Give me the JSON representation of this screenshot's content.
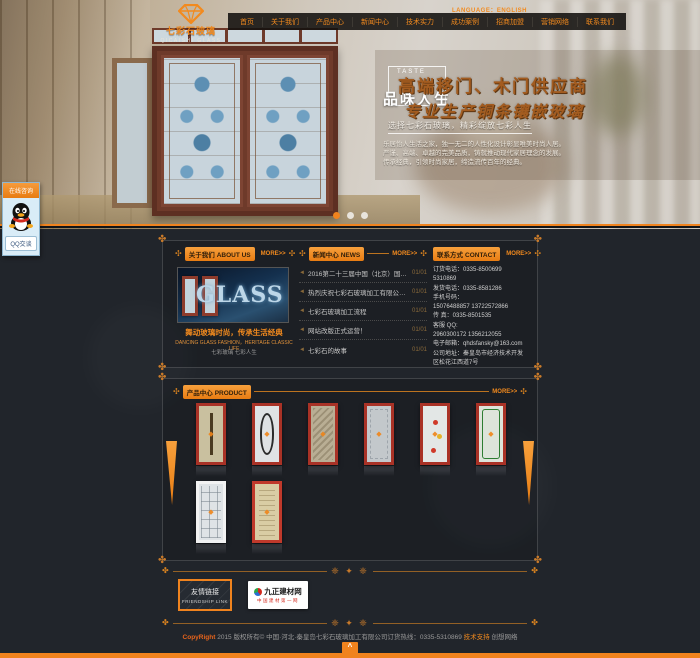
{
  "brand": {
    "logo_cn": "七彩石玻璃",
    "logo_en": "QICAISHI GLASS"
  },
  "topbar": {
    "language": "LANGUAGE：ENGLISH"
  },
  "nav": {
    "items": [
      "首页",
      "关于我们",
      "产品中心",
      "新闻中心",
      "技术实力",
      "成功案例",
      "招商加盟",
      "营销网络",
      "联系我们"
    ]
  },
  "banner": {
    "taste_en": "TASTE",
    "taste_cn": "品味人生",
    "headline1": "高端移门、木门供应商",
    "headline2": "专业生产铜条镶嵌玻璃",
    "subline": "选择七彩石玻璃，精彩绽放七彩人生",
    "desc1": "乐居怡人生活之家，独一无二的人性化设计彰显唯美时尚人居。",
    "desc2": "严谨、高端、卓越的完美品质，铸就推动现代家居理念的发展。",
    "desc3": "传承经典，引领时尚家居，缔造流传百年的经典。",
    "dot_count": 3,
    "active_dot": 0
  },
  "qq": {
    "title": "在线咨询",
    "button": "QQ交谈"
  },
  "sections": {
    "about": {
      "title_cn": "关于我们",
      "title_en": "ABOUT US",
      "more": "MORE>>",
      "image_text": "GLASS",
      "caption1": "舞动玻璃时尚，传承生活经典",
      "caption2": "DANCING GLASS FASHION，HERITAGE CLASSIC LIFE",
      "caption3": "七彩玻璃 七彩人生"
    },
    "news": {
      "title_cn": "新闻中心",
      "title_en": "NEWS",
      "more": "MORE>>",
      "items": [
        {
          "title": "2016第二十三届中国（北京）国际...",
          "date": "01/01"
        },
        {
          "title": "热烈庆祝七彩石玻璃加工有限公司网...",
          "date": "01/01"
        },
        {
          "title": "七彩石玻璃加工流程",
          "date": "01/01"
        },
        {
          "title": "网站改版正式运营！",
          "date": "01/01"
        },
        {
          "title": "七彩石的故事",
          "date": "01/01"
        }
      ]
    },
    "contact": {
      "title_cn": "联系方式",
      "title_en": "CONTACT",
      "more": "MORE>>",
      "lines": [
        "订货电话：0335-8500699",
        "5310869",
        "发货电话：0335-8581286",
        "手机号码：",
        "15076488857 13722572866",
        "传  真：0335-8501535",
        "客服 QQ:",
        "2960300172 1356212055",
        "电子邮箱：qhdsfansky@163.com",
        "公司地址：秦皇岛市经济技术开发",
        "区松花江西道7号"
      ]
    },
    "products": {
      "title_cn": "产品中心",
      "title_en": "PRODUCT",
      "more": "MORE>>",
      "items": [
        {
          "name": "inlaid-glass-door-1",
          "frame": "#a93226",
          "glass": "#c9c09f",
          "motif_color": "#4a3a20",
          "motif": "column"
        },
        {
          "name": "inlaid-glass-door-2",
          "frame": "#a93226",
          "glass": "#dfe2e4",
          "motif_color": "#2b2b2b",
          "motif": "oval"
        },
        {
          "name": "inlaid-glass-door-3",
          "frame": "#a93226",
          "glass": "#b9ae94",
          "motif_color": "#8d8066",
          "motif": "texture"
        },
        {
          "name": "inlaid-glass-door-4",
          "frame": "#a93226",
          "glass": "#c3c8cb",
          "motif_color": "#9aa2a8",
          "motif": "frost"
        },
        {
          "name": "inlaid-glass-door-5",
          "frame": "#a93226",
          "glass": "#e3e7e6",
          "motif_color": "#cf3a2a",
          "motif": "roses"
        },
        {
          "name": "inlaid-glass-door-6",
          "frame": "#a93226",
          "glass": "#dde4da",
          "motif_color": "#2e7d32",
          "motif": "leaf"
        },
        {
          "name": "inlaid-glass-door-7",
          "frame": "#f2f2f2",
          "glass": "#dfe3e6",
          "motif_color": "#aeb6bc",
          "motif": "grid"
        },
        {
          "name": "inlaid-glass-door-8",
          "frame": "#c0392b",
          "glass": "#d9cda4",
          "motif_color": "#b9a97a",
          "motif": "parchment"
        }
      ]
    }
  },
  "friendship": {
    "title_cn": "友情链接",
    "title_en": "FRIENDSHIP LINK",
    "partner": {
      "name": "九正建材网",
      "tagline": "中国建材第一网"
    }
  },
  "footer": {
    "copyright_prefix": "CopyRight",
    "text": " 2015 版权所有© 中国·河北·秦皇岛七彩石玻璃加工有限公司订货热线：0335-5310869 ",
    "support_label": "技术支持",
    "support_name": " 创想网络",
    "back_to_top": "^"
  },
  "colors": {
    "accent": "#f0831e",
    "nav_bg": "#121212",
    "page_bg": "#21252b"
  }
}
